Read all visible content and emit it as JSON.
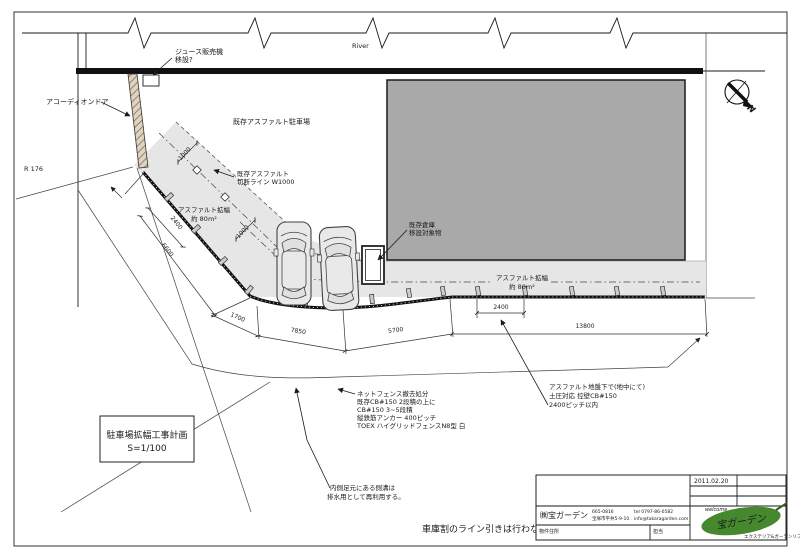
{
  "drawing": {
    "river_label": "River",
    "road_label": "R 176",
    "north_label": "N",
    "labels": {
      "vending_machine": [
        "ジュース販売機",
        "移設?"
      ],
      "accordion_door": "アコーディオンドア",
      "existing_parking": "既存アスファルト駐車場",
      "cut_line": [
        "既存アスファルト",
        "切断ライン W1000"
      ],
      "widening_left": [
        "アスファルト拡幅",
        "約 80m²"
      ],
      "widening_right": [
        "アスファルト拡幅",
        "約 80m²"
      ],
      "warehouse": [
        "既存倉庫",
        "移設対象物"
      ]
    },
    "dimensions": {
      "d1000a": "1000",
      "d1000b": "1000",
      "d2400_diag": "2400",
      "d6600": "6600",
      "d1700": "1700",
      "d7850": "7850",
      "d5700": "5700",
      "d2400_pitch": "2400",
      "d13800": "13800"
    },
    "notes": {
      "fence": [
        "ネットフェンス撤去処分",
        "既存CB#150 2段積の上に",
        "CB#150 3~5段積",
        "縦鉄筋アンカー 400ピッチ",
        "TOEX ハイグリッドフェンスN8型 白"
      ],
      "underground": [
        "アスファルト地盤下で(地中にて)",
        "土圧対応 控壁CB#150",
        "2400ピッチ以内"
      ],
      "gutter": [
        "内側足元にある側溝は",
        "排水用として再利用する。"
      ],
      "no_lines": "車庫割のライン引きは行わない"
    },
    "title_box": [
      "駐車場拡幅工事計画",
      "S=1/100"
    ]
  },
  "title_block": {
    "date": "2011.02.20",
    "company": "㈱宝ガーデン",
    "postal_code": "665-0816",
    "address": "宝塚市平井5-9-10",
    "tel": "tel 0797-86-0582",
    "email": "info@takaragarden.com",
    "property_label": "物件住所",
    "staff_label": "担当",
    "logo": {
      "tagline_top": "welcome",
      "name": "宝ガーデン",
      "tagline_bottom": "エクステリア&ガーデンリフォーム"
    }
  },
  "colors": {
    "building_fill": "#a9a9a9",
    "asphalt_fill": "#e6e6e6",
    "hatch_fill": "#dfd4c2",
    "logo_green": "#45882e",
    "logo_yellow": "#c9a227",
    "line": "#1a1a1a"
  }
}
